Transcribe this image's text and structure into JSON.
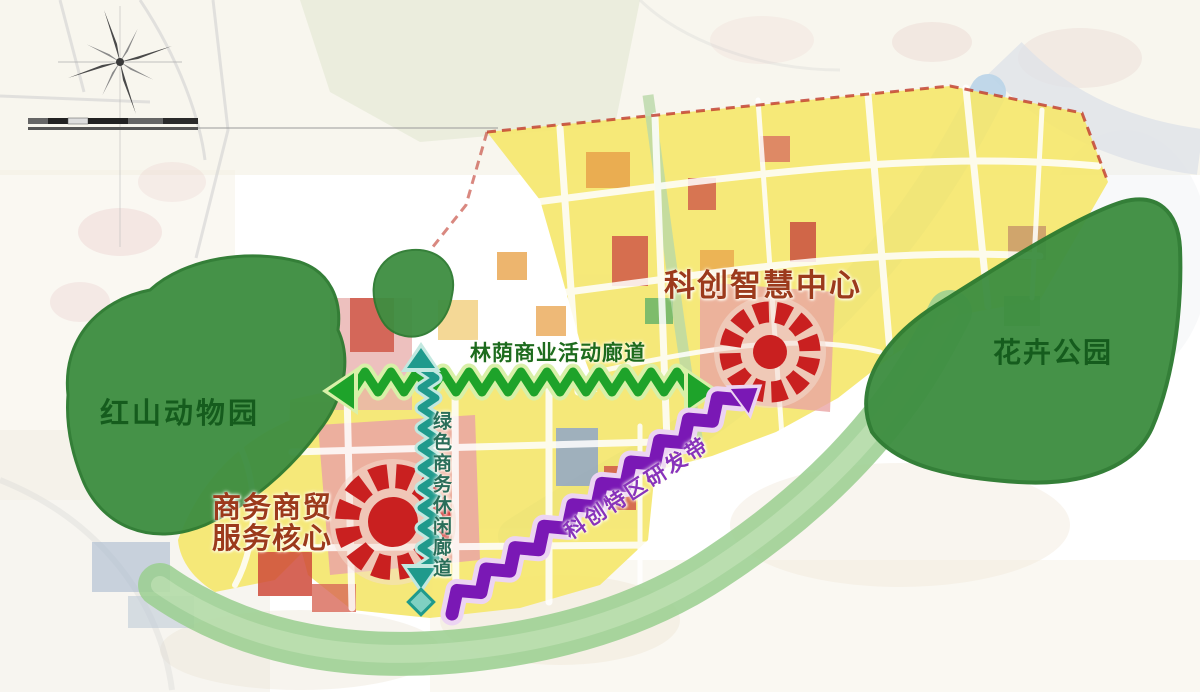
{
  "map": {
    "title": "科创智慧中心片区规划示意图",
    "labels": {
      "zoo": "红山动物园",
      "flower_park": "花卉公园",
      "smart_center": "科创智慧中心",
      "business_core_line1": "商务商贸",
      "business_core_line2": "服务核心",
      "corridor_horizontal": "林荫商业活动廊道",
      "corridor_vertical": "绿色商务休闲廊道",
      "rd_belt": "科创特区研发带"
    },
    "icons": {
      "compass": "compass-rose-icon",
      "scale": "scale-bar",
      "hub": "radial-burst-icon",
      "corridor_arrow": "zigzag-double-arrow",
      "belt_arrow": "zigzag-arrow"
    },
    "colors": {
      "park_green": "#3e8e41",
      "park_edge": "#2c7a30",
      "label_green": "#155c1d",
      "corridor_green": "#1ea32a",
      "corridor_green_halo": "#d9f0a8",
      "corridor_h_label": "#1d6b1d",
      "corridor_teal": "#1f9a8c",
      "corridor_teal_halo": "#c2e8e0",
      "corridor_v_label": "#2a6e5a",
      "belt_purple": "#7a18b5",
      "belt_purple_halo": "#ecd4f2",
      "label_purple": "#8833bb",
      "label_red": "#9c3a1c",
      "icon_red": "#c92020",
      "icon_disc": "#f3ddd0",
      "parcel_yellow": "#f5e76e",
      "parcel_pink": "#eaa4a4",
      "parcel_red": "#d05848",
      "parcel_orange": "#e8a24a",
      "parcel_blue": "#8fa6c8",
      "river_blue": "#b9d4e8",
      "greenway": "#9ccf92",
      "boundary_red": "#c0392b"
    }
  }
}
